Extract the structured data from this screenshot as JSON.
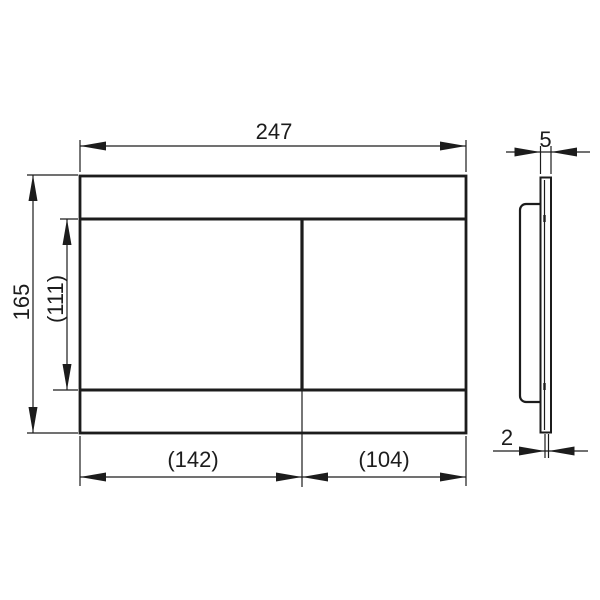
{
  "front_view": {
    "overall_width_label": "247",
    "overall_height_label": "165",
    "button_area_height_label": "(111)",
    "left_button_width_label": "(142)",
    "right_button_width_label": "(104)"
  },
  "side_view": {
    "top_thickness_label": "5",
    "bottom_thickness_label": "2"
  },
  "colors": {
    "line": "#1c1c1c",
    "background": "#ffffff"
  }
}
